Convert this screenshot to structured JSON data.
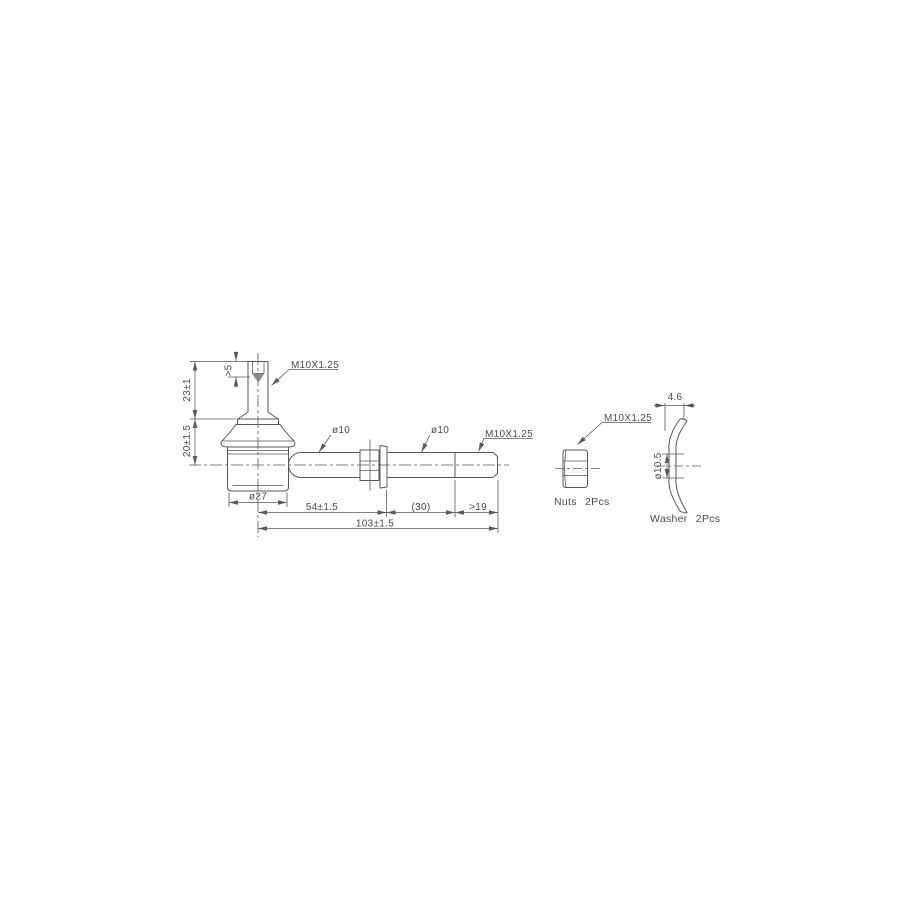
{
  "drawing": {
    "background_color": "#ffffff",
    "line_color": "#595959",
    "text_color": "#4c4c4c",
    "main_view": {
      "labels": {
        "stud_thread": "M10X1.25",
        "rod_dia_left": "ø10",
        "rod_dia_right": "ø10",
        "rod_end_thread": "M10X1.25"
      },
      "dimensions": {
        "stud_tip": ">5",
        "stud_height": "23±1",
        "socket_height": "20±1.5",
        "housing_dia": "ø27",
        "center_to_collar": "54±1.5",
        "mid_section": "(30)",
        "thread_length": ">19",
        "overall": "103±1.5"
      }
    },
    "nut_view": {
      "thread_label": "M10X1.25",
      "caption": "Nuts 2Pcs"
    },
    "washer_view": {
      "thickness": "4.6",
      "hole_dia": "ø10.5",
      "caption": "Washer 2Pcs"
    }
  }
}
